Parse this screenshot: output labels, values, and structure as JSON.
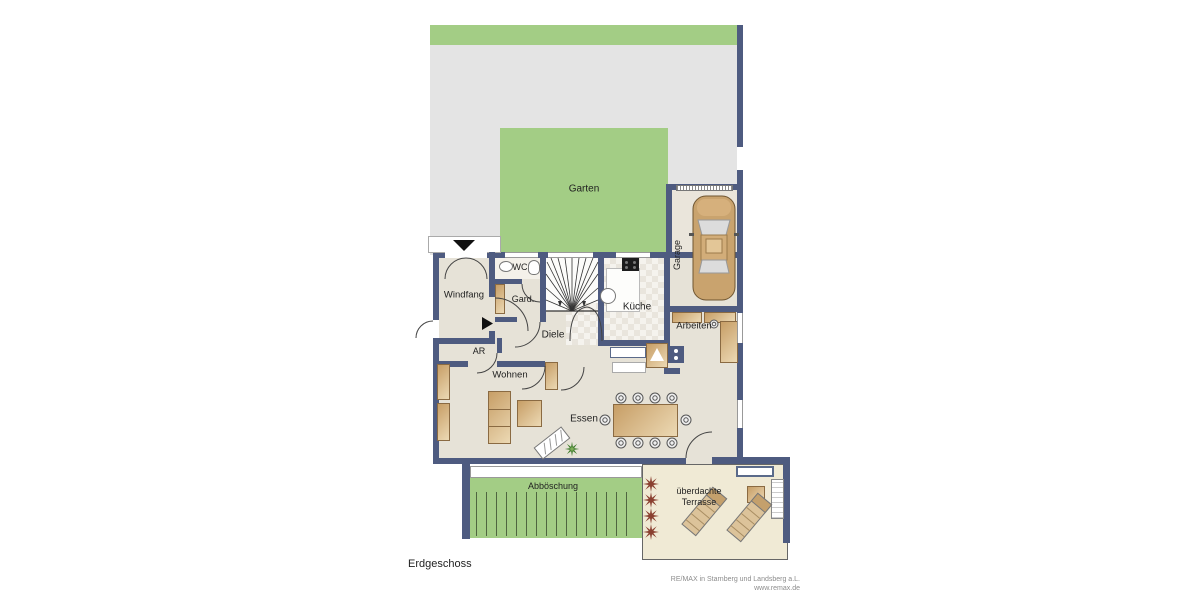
{
  "floor_label": "Erdgeschoss",
  "rooms": {
    "garten": "Garten",
    "garage": "Garage",
    "windfang": "Windfang",
    "wc": "WC",
    "garderobe": "Gard.",
    "kueche": "Küche",
    "diele": "Diele",
    "ar": "AR",
    "arbeiten": "Arbeiten",
    "wohnen": "Wohnen",
    "essen": "Essen",
    "abboeschung": "Abböschung",
    "terrasse_line1": "überdachte",
    "terrasse_line2": "Terrasse"
  },
  "footer": {
    "company": "RE/MAX in Starnberg und Landsberg a.L.",
    "website": "www.remax.de"
  },
  "colors": {
    "wall": "#4e5b80",
    "plot": "#e4e4e4",
    "grass": "#a3cd85",
    "floor": "#e6e2d7",
    "terrace": "#f0ead5",
    "garagefloor": "#eae5db",
    "furn": "#d7b98d",
    "plantred": "#8a4030",
    "plantgreen": "#3f7d2c"
  }
}
